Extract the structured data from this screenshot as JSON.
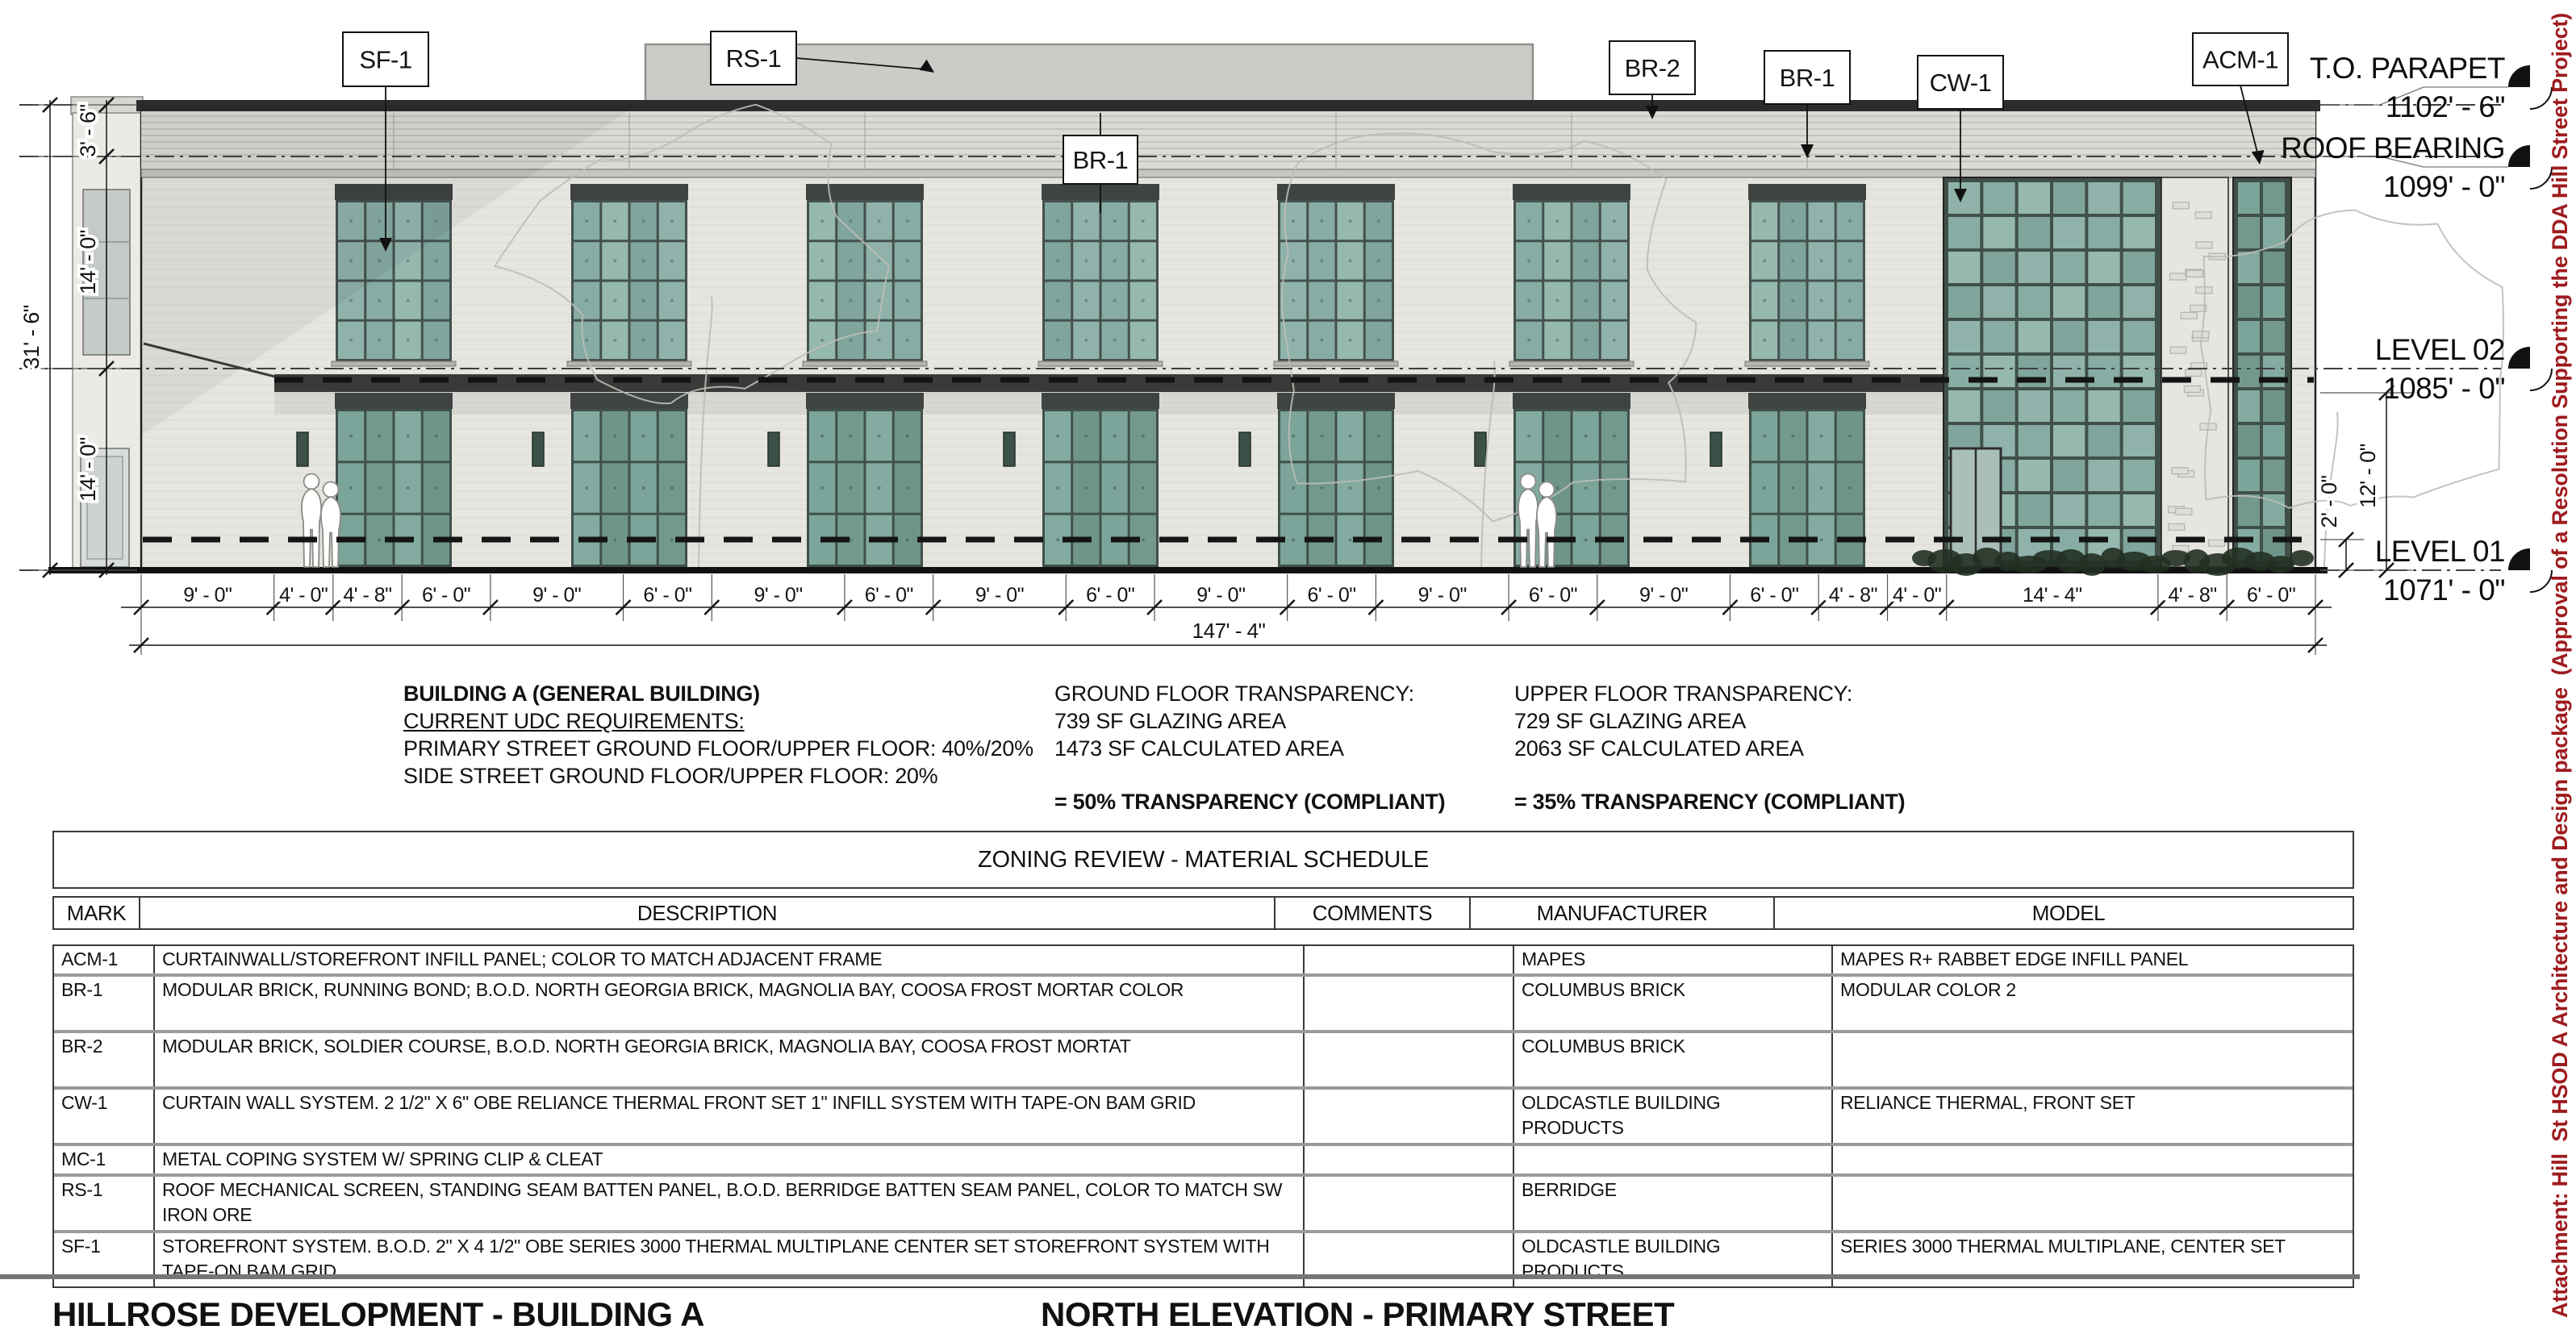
{
  "drawing": {
    "view_name": "NORTH ELEVATION - PRIMARY STREET",
    "material_tags": [
      "SF-1",
      "RS-1",
      "BR-2",
      "BR-1",
      "CW-1",
      "ACM-1",
      "BR-1"
    ],
    "levels": [
      {
        "name": "T.O. PARAPET",
        "elev": "1102' - 6\""
      },
      {
        "name": "ROOF BEARING",
        "elev": "1099' - 0\""
      },
      {
        "name": "LEVEL 02",
        "elev": "1085' - 0\""
      },
      {
        "name": "LEVEL 01",
        "elev": "1071' - 0\""
      }
    ],
    "dims_bottom": [
      "9' - 0\"",
      "4' - 0\"",
      "4' - 8\"",
      "6' - 0\"",
      "9' - 0\"",
      "6' - 0\"",
      "9' - 0\"",
      "6' - 0\"",
      "9' - 0\"",
      "6' - 0\"",
      "9' - 0\"",
      "6' - 0\"",
      "9' - 0\"",
      "6' - 0\"",
      "9' - 0\"",
      "6' - 0\"",
      "4' - 8\"",
      "4' - 0\"",
      "14' - 4\"",
      "4' - 8\"",
      "6' - 0\""
    ],
    "dims_bottom_ft": [
      9,
      4,
      4.6667,
      6,
      9,
      6,
      9,
      6,
      9,
      6,
      9,
      6,
      9,
      6,
      9,
      6,
      4.6667,
      4,
      14.3333,
      4.6667,
      6
    ],
    "dim_overall": "147' - 4\"",
    "dims_left": {
      "overall": "31' - 6\"",
      "segments": [
        "3' - 6\"",
        "14' - 0\"",
        "14' - 0\""
      ]
    },
    "dims_right": [
      "2' - 0\"",
      "12' - 0\""
    ],
    "colors": {
      "brick": "#E6E5E0",
      "parapet_band": "#DBDAD4",
      "coping": "#2C2C2C",
      "glazing": "#8FB3AA",
      "frame": "#3F4443",
      "roof_screen": "#CBCBC7",
      "canopy": "#3A3A38"
    }
  },
  "notes": {
    "building_a": {
      "line1": "BUILDING A (GENERAL BUILDING)",
      "line2": "CURRENT UDC REQUIREMENTS:",
      "line3": "PRIMARY STREET GROUND FLOOR/UPPER FLOOR: 40%/20%",
      "line4": "SIDE STREET GROUND FLOOR/UPPER FLOOR: 20%"
    },
    "ground_floor": {
      "title": "GROUND FLOOR TRANSPARENCY:",
      "line1": "739 SF GLAZING AREA",
      "line2": "1473 SF CALCULATED AREA",
      "result": "= 50% TRANSPARENCY (COMPLIANT)"
    },
    "upper_floor": {
      "title": "UPPER FLOOR TRANSPARENCY:",
      "line1": "729 SF GLAZING AREA",
      "line2": "2063 SF CALCULATED AREA",
      "result": "= 35% TRANSPARENCY (COMPLIANT)"
    }
  },
  "schedule": {
    "title": "ZONING REVIEW - MATERIAL SCHEDULE",
    "columns": [
      "MARK",
      "DESCRIPTION",
      "COMMENTS",
      "MANUFACTURER",
      "MODEL"
    ],
    "rows": [
      {
        "mark": "ACM-1",
        "description": "CURTAINWALL/STOREFRONT INFILL PANEL; COLOR TO MATCH ADJACENT FRAME",
        "comments": "",
        "manufacturer": "MAPES",
        "model": "MAPES R+ RABBET EDGE INFILL PANEL"
      },
      {
        "mark": "BR-1",
        "description": "MODULAR BRICK, RUNNING BOND; B.O.D. NORTH GEORGIA BRICK, MAGNOLIA BAY, COOSA FROST MORTAR COLOR",
        "comments": "",
        "manufacturer": "COLUMBUS BRICK",
        "model": "MODULAR COLOR 2"
      },
      {
        "mark": "BR-2",
        "description": "MODULAR BRICK, SOLDIER COURSE, B.O.D. NORTH GEORGIA BRICK, MAGNOLIA BAY, COOSA FROST MORTAT",
        "comments": "",
        "manufacturer": "COLUMBUS BRICK",
        "model": ""
      },
      {
        "mark": "CW-1",
        "description": "CURTAIN WALL SYSTEM. 2 1/2\" X 6\" OBE RELIANCE THERMAL FRONT SET 1\" INFILL SYSTEM WITH TAPE-ON BAM GRID",
        "comments": "",
        "manufacturer": "OLDCASTLE BUILDING PRODUCTS",
        "model": "RELIANCE THERMAL, FRONT SET"
      },
      {
        "mark": "MC-1",
        "description": "METAL COPING SYSTEM W/ SPRING CLIP & CLEAT",
        "comments": "",
        "manufacturer": "",
        "model": ""
      },
      {
        "mark": "RS-1",
        "description": "ROOF MECHANICAL SCREEN, STANDING SEAM BATTEN PANEL, B.O.D. BERRIDGE BATTEN SEAM PANEL, COLOR TO MATCH SW IRON ORE",
        "comments": "",
        "manufacturer": "BERRIDGE",
        "model": ""
      },
      {
        "mark": "SF-1",
        "description": "STOREFRONT SYSTEM. B.O.D. 2\" X 4 1/2\" OBE SERIES 3000 THERMAL MULTIPLANE CENTER SET STOREFRONT SYSTEM WITH TAPE-ON BAM GRID",
        "comments": "",
        "manufacturer": "OLDCASTLE BUILDING PRODUCTS",
        "model": "SERIES 3000 THERMAL MULTIPLANE, CENTER SET"
      }
    ]
  },
  "footer": {
    "project": "HILLROSE DEVELOPMENT - BUILDING A",
    "view": "NORTH ELEVATION - PRIMARY STREET"
  },
  "sidebar": {
    "text": "Attachment: Hill  St HSOD A Architecture and Design package  (Approval of a Resolution Supporting the DDA Hill Street Project)",
    "color": "#9E1B1E"
  }
}
